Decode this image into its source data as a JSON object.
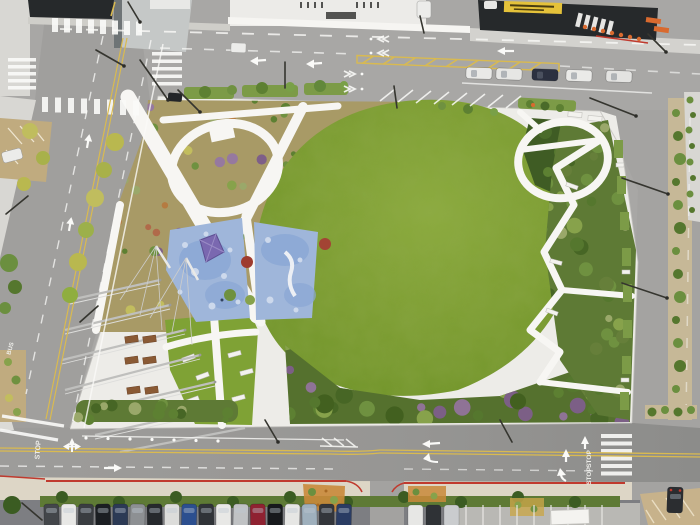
{
  "scene": {
    "kind": "aerial-drone-photo",
    "subject": "city park with large oval lawn, winding white paths, playground, canopy pavilion, surrounded by streets and parked cars"
  },
  "road_markings": {
    "stop_text": "STOP",
    "stop_text_2": "STOP",
    "stop_text_3": "STOP",
    "bus_text": "BUS"
  },
  "palette": {
    "asphalt": "#a8a7a5",
    "asphalt_left": "#a09f9d",
    "asphalt_right": "#a4a3a1",
    "sidewalk": "#d8d7d3",
    "park_paving": "#edece8",
    "park_path": "#f7f6f3",
    "lawn_center": "#8cab3e",
    "lawn_edge": "#6e9228",
    "garden_tan": "#a89a66",
    "south_garden_green": "#55712e",
    "east_strip_green": "#5e7a35",
    "mound_green": "#3f5c24",
    "playground_blue": "#9fb6da",
    "playground_blue_dark": "#8aa7d4",
    "play_structure_purple": "#7a68b0",
    "centerline_yellow": "#d9ba50",
    "curb_red": "#c03a2e",
    "cone_orange": "#d96a2f",
    "building_dark": "#26292b",
    "building_light": "#ecebe8",
    "sign_yellow": "#e5c23a",
    "lot_pavement": "#7d7e82",
    "bottom_sidewalk": "#ddd6c6",
    "dirt_tan": "#c7b28b"
  },
  "vehicles": {
    "bottom_row_colors": [
      "#43464a",
      "#e8e8e6",
      "#3a3d41",
      "#1b1e22",
      "#2c3a55",
      "#8d9093",
      "#26292d",
      "#dcdcda",
      "#2c4f8f",
      "#303338",
      "#e8e8e6",
      "#c0c2c4",
      "#8f2231",
      "#17191c",
      "#e6e6e4",
      "#9fb0bd",
      "#33363b",
      "#2a3c63"
    ],
    "second_row_colors": [
      "#e7e7e5",
      "#2f3236",
      "#caccce"
    ],
    "top_street_parked_colors": [
      "#e9e9e7",
      "#e6e6e4",
      "#2c3140",
      "#eaeae8",
      "#e3e3e1"
    ],
    "right_street_car_color": "#2b2d30",
    "plaza_car_color": "#ececea",
    "left_street_car_color": "#222528",
    "moving_car_color": "#ececea",
    "van_color": "#ececea",
    "corner_car_color": "#e8e8e6"
  },
  "landscape": {
    "median_tree_count": 13,
    "hedge_tree_count": 10,
    "garden_plant_colors": [
      "#6f9140",
      "#87a24b",
      "#5d8032",
      "#96799f",
      "#7e5f88",
      "#b57b41",
      "#c2bd5e",
      "#9aa86a",
      "#b06a4a"
    ],
    "south_tree_colors": [
      "#476625",
      "#5d8032",
      "#6f9140",
      "#87a24b",
      "#8f7396",
      "#7c5f86",
      "#42601f",
      "#55772e"
    ],
    "east_tree_colors": [
      "#476625",
      "#6f9140",
      "#87a24b",
      "#9aa86a",
      "#55772e",
      "#667f3a"
    ],
    "hedge_plant_colors": [
      "#476625",
      "#5d8032",
      "#6f9140",
      "#9aa86a"
    ],
    "street_tree_colors": [
      "#b9b84f",
      "#a8b14a",
      "#c0bd5e",
      "#9cb04a",
      "#8fae3f"
    ],
    "median_tree_colors": [
      "#6b8f3f",
      "#55772e"
    ]
  }
}
